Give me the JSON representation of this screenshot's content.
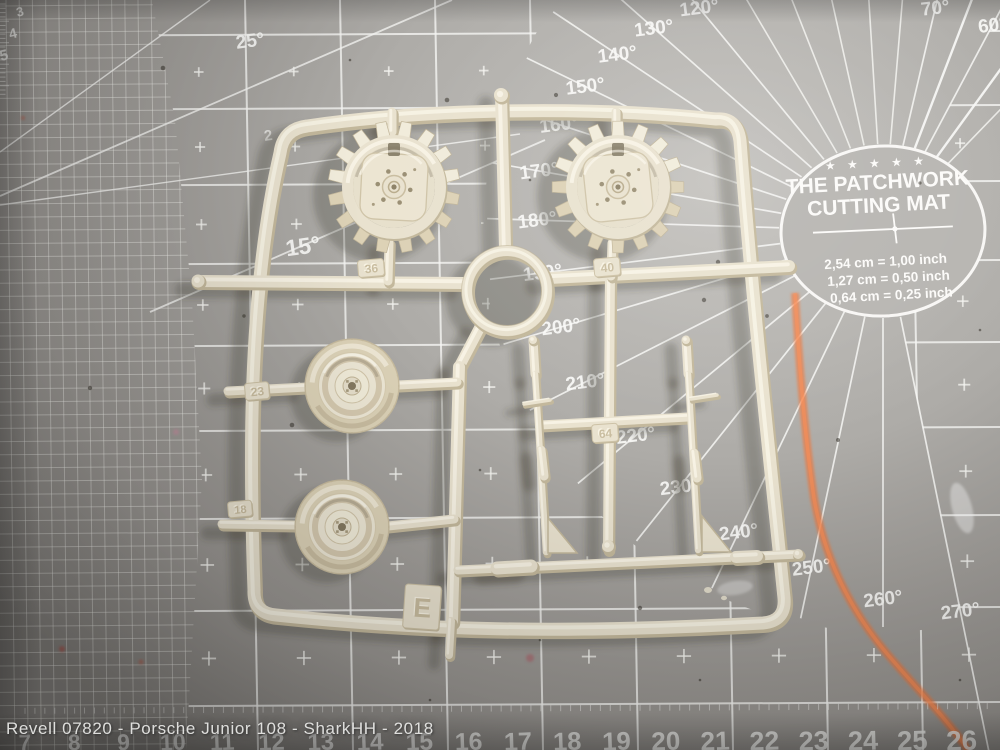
{
  "watermark": "Revell 07820 - Porsche Junior 108 - SharkHH - 2018",
  "mat": {
    "brand": {
      "stars": "★ ★ ★ ★ ★",
      "line1": "THE PATCHWORK",
      "line2": "CUTTING MAT",
      "conversions": [
        "2,54 cm = 1,00 inch",
        "1,27 cm = 0,50 inch",
        "0,64 cm = 0,25 inch"
      ]
    },
    "fan_labels": [
      "270°",
      "260°",
      "250°",
      "240°",
      "230°",
      "220°",
      "210°",
      "200°",
      "190°",
      "180°",
      "170°",
      "160°",
      "150°",
      "140°",
      "130°",
      "120°",
      "70°",
      "60°"
    ],
    "angle_labels": {
      "label_25": "25°",
      "label_15": "15°"
    },
    "grid_number": "2",
    "bottom_ruler_numbers": [
      "7",
      "8",
      "9",
      "10",
      "11",
      "12",
      "13",
      "14",
      "15",
      "16",
      "17",
      "18",
      "19",
      "20",
      "21",
      "22",
      "23",
      "24",
      "25",
      "26"
    ],
    "left_ruler_numbers": [
      "3",
      "4",
      "5"
    ],
    "colors": {
      "surface": "#a4a19d",
      "grid_line": "#f5f5f2",
      "chalk": "#f0763a"
    }
  },
  "sprue": {
    "letter": "E",
    "part_tags": [
      "36",
      "40",
      "23",
      "18",
      "64"
    ],
    "color": "#e9e2cf"
  }
}
